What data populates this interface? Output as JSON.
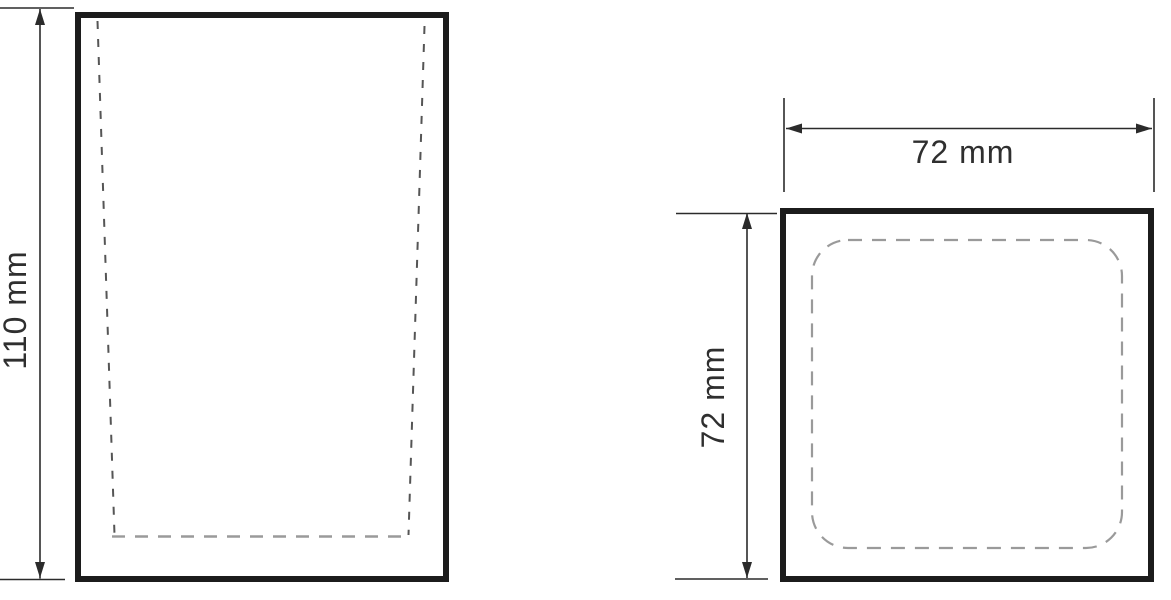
{
  "drawing": {
    "views": {
      "front": {
        "height_label": "110 mm",
        "height_mm": 110
      },
      "top": {
        "width_label": "72 mm",
        "width_mm": 72,
        "depth_label": "72 mm",
        "depth_mm": 72
      }
    },
    "colors": {
      "outline": "#1c1c1c",
      "dimension": "#2b2b2b",
      "label_text": "#2f2f2f",
      "dashed_dark": "#555555",
      "dashed_light": "#9a9a9a",
      "background": "#ffffff"
    }
  }
}
